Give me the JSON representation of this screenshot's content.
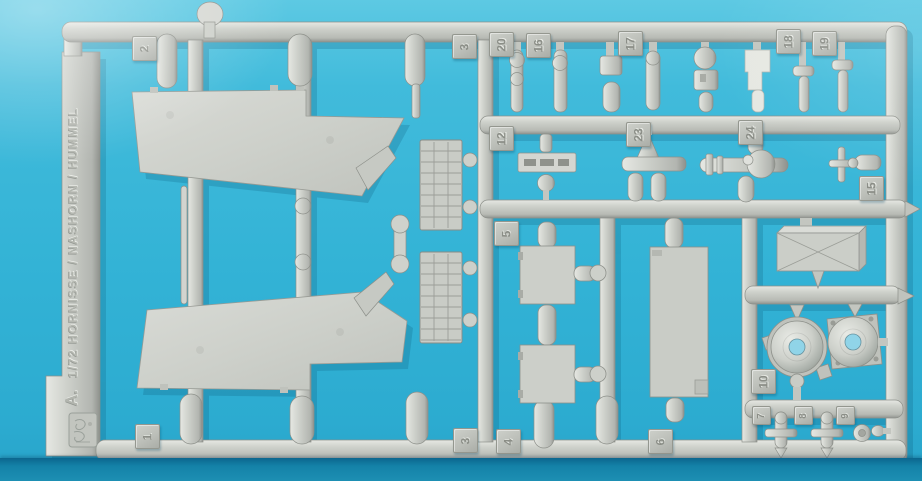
{
  "scene": {
    "description": "photo of injection-molded model kit sprue on cyan background",
    "background_color": "#33b3d6",
    "shadow_band_color": "#1482a8",
    "sprue_color": "#c7cac3"
  },
  "sprue": {
    "label_letter": "A.",
    "label_text": "1/72 HORNISSE / NASHORN / HUMMEL",
    "emblem": "maker-stamp-emblem",
    "tags": [
      {
        "label": "2"
      },
      {
        "label": "3"
      },
      {
        "label": "20"
      },
      {
        "label": "16"
      },
      {
        "label": "17"
      },
      {
        "label": "18"
      },
      {
        "label": "19"
      },
      {
        "label": "12"
      },
      {
        "label": "23"
      },
      {
        "label": "24"
      },
      {
        "label": "15"
      },
      {
        "label": "5"
      },
      {
        "label": "10"
      },
      {
        "label": "1"
      },
      {
        "label": "3"
      },
      {
        "label": "4"
      },
      {
        "label": "6"
      },
      {
        "label": "7"
      },
      {
        "label": "8"
      },
      {
        "label": "9"
      }
    ],
    "parts": [
      "superstructure-side-panel-upper",
      "superstructure-side-panel-lower",
      "engine-grille-upper",
      "engine-grille-lower",
      "tow-bar-dumbbell",
      "hatch-panel-upper",
      "hatch-panel-lower",
      "fighting-compartment-floor",
      "stowage-box",
      "drive-housing-left",
      "drive-housing-right",
      "suspension-spool-left",
      "suspension-spool-right",
      "small-road-wheel",
      "track-link-bar",
      "exhaust-pipe-assembly"
    ]
  }
}
